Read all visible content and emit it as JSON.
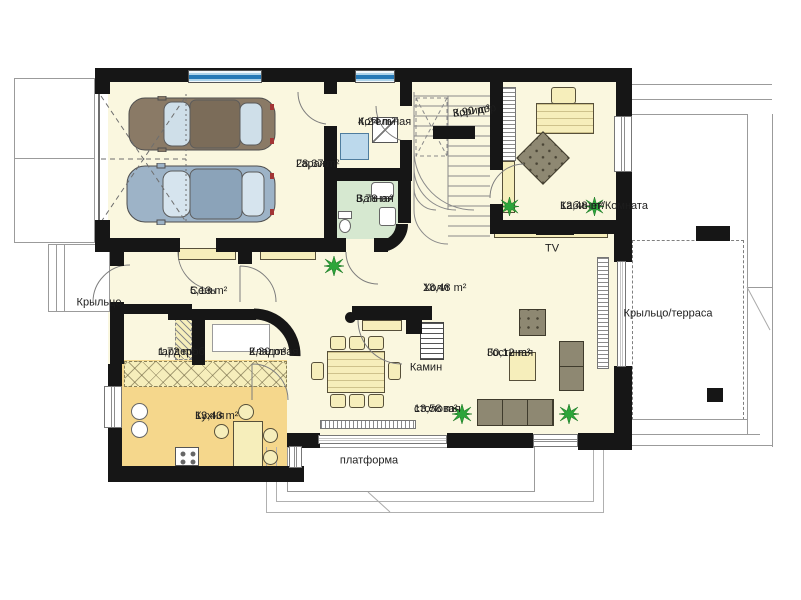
{
  "plan": {
    "rooms": [
      {
        "id": "garage",
        "label": "Гараж",
        "area": "28,37 m²"
      },
      {
        "id": "boiler",
        "label": "Котельная",
        "area": "4,24 m²"
      },
      {
        "id": "corridor",
        "label": "Коридор",
        "area": "3,90 m²"
      },
      {
        "id": "office",
        "label": "Кабинет/Комната",
        "area": "12,48 m²"
      },
      {
        "id": "bathroom",
        "label": "Ванная",
        "area": "3,78 m²"
      },
      {
        "id": "vestibule",
        "label": "Сень",
        "area": "5,13 m²"
      },
      {
        "id": "hall",
        "label": "Холл",
        "area": "18,48 m²"
      },
      {
        "id": "wardrobe",
        "label": "гардероб",
        "area": "1,72 m²"
      },
      {
        "id": "pantry",
        "label": "Кладовая",
        "area": "2,30 m²"
      },
      {
        "id": "kitchen",
        "label": "Кухня",
        "area": "13,43 m²"
      },
      {
        "id": "dining",
        "label": "столовая",
        "area": "13,58 m²"
      },
      {
        "id": "living",
        "label": "Гостиная",
        "area": "30,12 m²"
      }
    ],
    "outdoor": {
      "porch": "Крыльцо",
      "terrace": "Крыльцо/терраса",
      "platform": "платформа"
    },
    "annotations": {
      "fireplace": "Камин",
      "tv": "TV"
    },
    "colors": {
      "wall": "#161616",
      "floor": "#faf7df",
      "kitchen_floor": "#f5d78c",
      "bathroom_floor": "#d6e8d0",
      "furniture": "#f6eebb",
      "sofa_brown": "#8e8872",
      "window_glass_blue": "#2679b6",
      "plant_green": "#2ca53a",
      "car_brown": "#8a7a66",
      "car_blue": "#9db3c7"
    }
  }
}
